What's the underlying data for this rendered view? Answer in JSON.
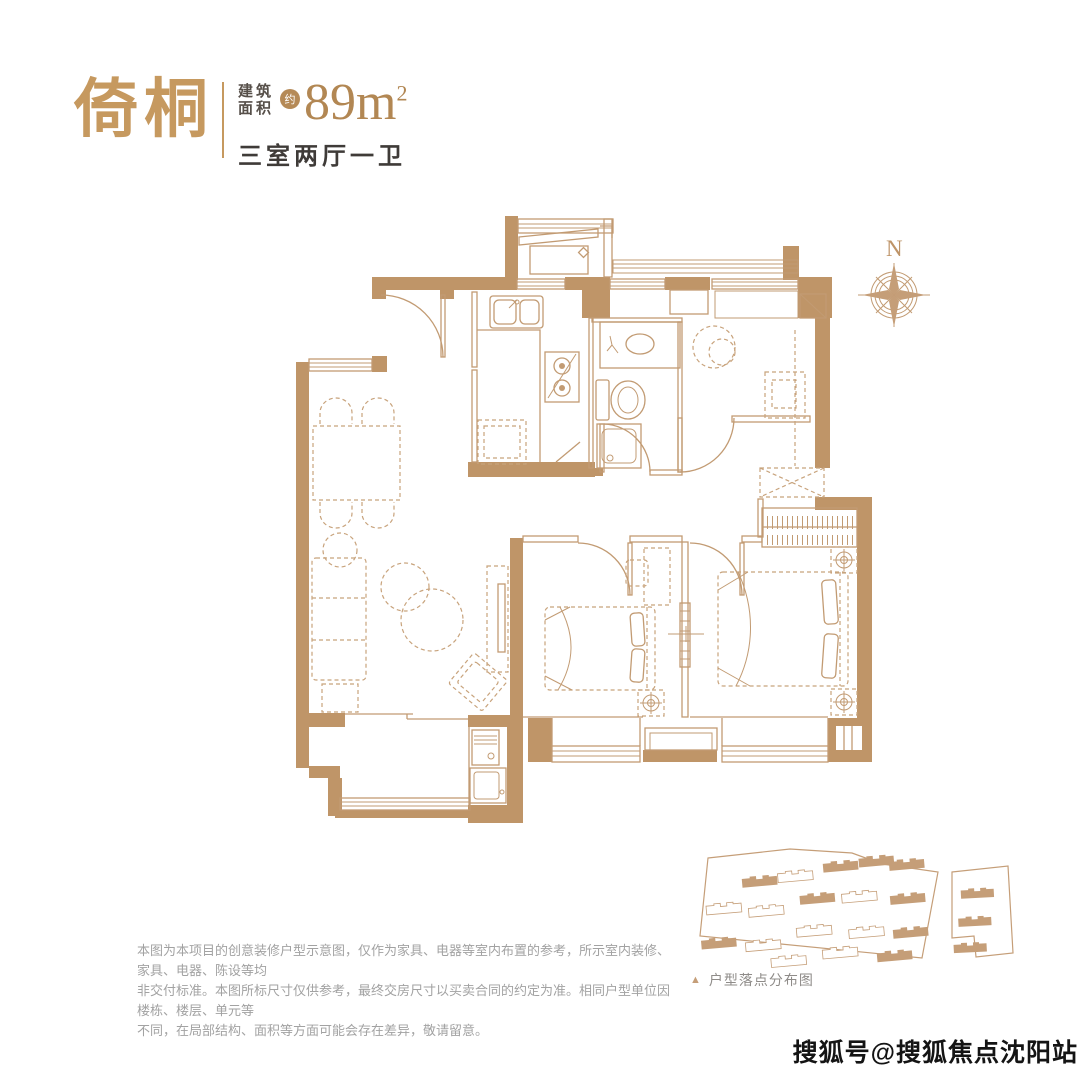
{
  "palette": {
    "accent_tan": "#C6995F",
    "wall_tan": "#BF9568",
    "line_tan": "#C29B73",
    "dark_text": "#3F3B38",
    "gray_text": "#A2A2A2",
    "background": "#FFFFFF"
  },
  "header": {
    "title": "倚桐",
    "area_label_line1": "建筑",
    "area_label_line2": "面积",
    "approx": "约",
    "area_value": "89",
    "area_unit": "m",
    "area_sup": "2",
    "layout": "三室两厅一卫"
  },
  "compass": {
    "north_label": "N"
  },
  "site_map": {
    "marker": "▲",
    "caption": "户型落点分布图"
  },
  "disclaimer": {
    "line1": "本图为本项目的创意装修户型示意图，仅作为家具、电器等室内布置的参考，所示室内装修、家具、电器、陈设等均",
    "line2": "非交付标准。本图所标尺寸仅供参考，最终交房尺寸以买卖合同的约定为准。相同户型单位因楼栋、楼层、单元等",
    "line3": "不同，在局部结构、面积等方面可能会存在差异，敬请留意。"
  },
  "watermark": {
    "text": "搜狐号@搜狐焦点沈阳站"
  }
}
